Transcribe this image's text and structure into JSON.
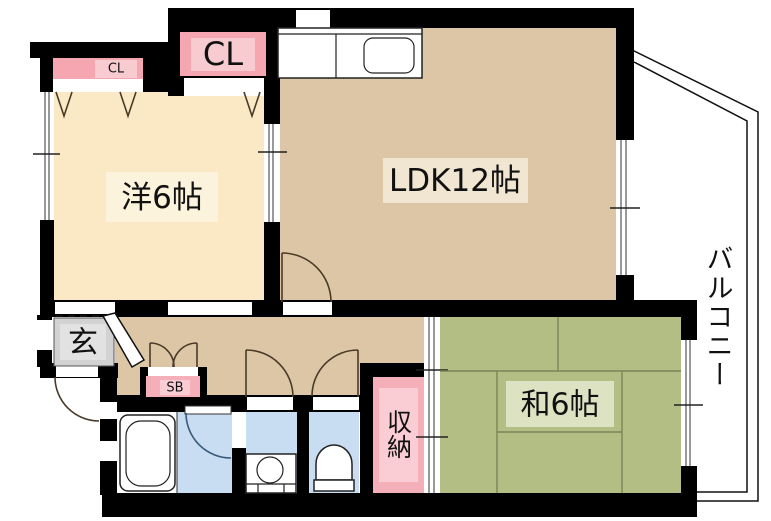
{
  "rooms": {
    "western": {
      "label": "洋6帖"
    },
    "ldk": {
      "label": "LDK12帖"
    },
    "japanese": {
      "label": "和6帖"
    },
    "balcony": {
      "label": "バルコニー"
    },
    "entrance": {
      "label": "玄"
    },
    "storage": {
      "label": "収納"
    },
    "closet": {
      "label": "CL"
    },
    "closet_small": {
      "label": "CL"
    },
    "shoebox": {
      "label": "SB"
    }
  },
  "colors": {
    "wall": "#000000",
    "western_room": "#FAE9C4",
    "ldk": "#DCC6A5",
    "hallway": "#DCC6A5",
    "japanese_room": "#B3BE84",
    "wet_area": "#C8DDF2",
    "bath_floor": "#FDFDFD",
    "closet_pink": "#F5A6B0",
    "closet_pink_light": "#F8CBD0",
    "storage_pink": "#F5AFB8",
    "storage_pink_light": "#F9CDD3",
    "entrance_gray": "#D2D2D2",
    "entrance_gray_light": "#E2E2E2",
    "label_bg_western": "#FCF3DC",
    "label_bg_ldk": "#F0E6D2",
    "label_bg_japanese": "#DDE2C2",
    "tatami_line": "#7A8456",
    "door_arc": "#4A3A28",
    "bath_door_arc": "#3A5878"
  }
}
